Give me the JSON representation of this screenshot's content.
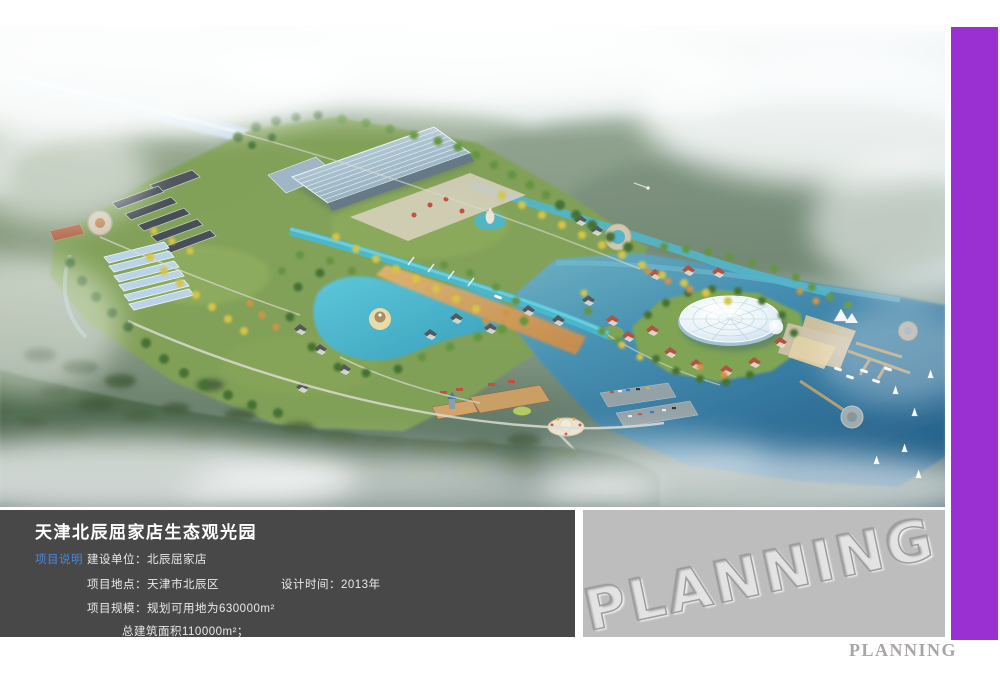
{
  "colors": {
    "accent_purple": "#9a30d2",
    "panel_dark": "#484848",
    "panel_gray": "#bdbdbd",
    "tag_blue": "#4a86dc",
    "footer_gray": "#a9a5a7",
    "water_deep": "#245f8c",
    "water_lake": "#3fb6cc"
  },
  "info": {
    "title": "天津北辰屈家店生态观光园",
    "tag": "项目说明",
    "construction_unit": "建设单位：北辰屈家店",
    "location": "项目地点：天津市北辰区",
    "design_time": "设计时间：2013年",
    "scale": "项目规模：规划可用地为630000m²",
    "total_area": "总建筑面积110000m²；"
  },
  "watermark": {
    "text": "PLANNING"
  },
  "footer": {
    "brand": "PLANNING"
  }
}
